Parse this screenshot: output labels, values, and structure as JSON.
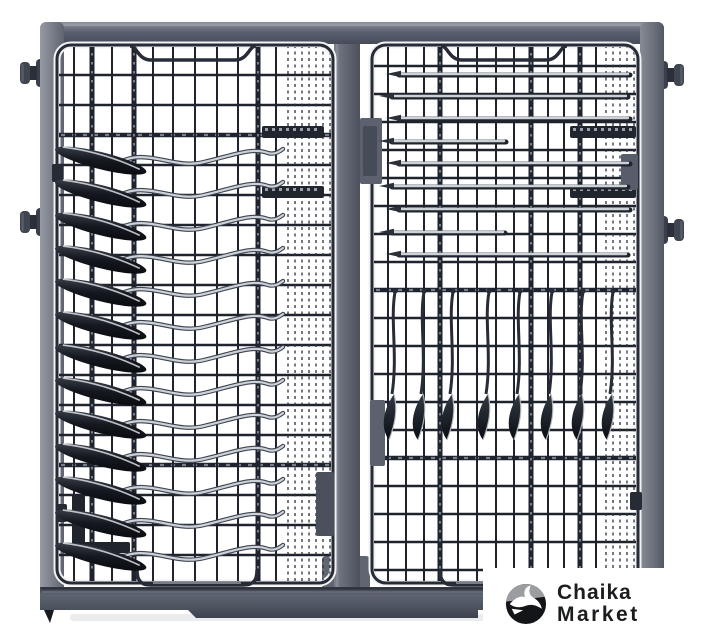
{
  "brand": {
    "line1": "Chaika",
    "line2": "Market"
  },
  "image": {
    "type": "product-photo",
    "subject": "dishwasher cutlery tray (third rack) loaded with knives and skewers, top view",
    "background": "#ffffff"
  },
  "colors": {
    "frame_gray": "#5d6370",
    "frame_light": "#8d929c",
    "wire_dark": "#1e232d",
    "wire_outline": "#262b35",
    "halo_white": "#f1f2f4",
    "metal_silver": "#cdd2d9",
    "utensil_dark": "#10131a",
    "logo_black": "#141518",
    "logo_gray": "#9b9da0",
    "text_dark": "#1b1d1f"
  },
  "scene": {
    "frame": {
      "top_bar": {
        "x": 40,
        "y": 22,
        "w": 624,
        "h": 22
      },
      "left_bar": {
        "x": 40,
        "y": 22,
        "w": 24,
        "h": 588
      },
      "right_bar": {
        "x": 640,
        "y": 22,
        "w": 24,
        "h": 600
      },
      "knobs": [
        {
          "side": "left",
          "x": 46,
          "y": 57
        },
        {
          "side": "left",
          "x": 46,
          "y": 206
        },
        {
          "side": "right",
          "x": 658,
          "y": 59
        },
        {
          "side": "right",
          "x": 658,
          "y": 214
        }
      ]
    },
    "divider": {
      "x": 334,
      "y": 44,
      "w": 26,
      "h": 546
    },
    "divider_foot": {
      "x": 322,
      "y": 556,
      "w": 48,
      "h": 34
    },
    "baskets": [
      {
        "id": "left",
        "x": 57,
        "y": 45,
        "w": 276,
        "h": 538,
        "r": 14,
        "verticals": [
          {
            "x": 74,
            "w": 2
          },
          {
            "x": 92,
            "w": 5
          },
          {
            "x": 112,
            "w": 2
          },
          {
            "x": 134,
            "w": 5
          },
          {
            "x": 153,
            "w": 2
          },
          {
            "x": 173,
            "w": 2
          },
          {
            "x": 195,
            "w": 2
          },
          {
            "x": 217,
            "w": 2
          },
          {
            "x": 238,
            "w": 2
          },
          {
            "x": 258,
            "w": 5
          },
          {
            "x": 276,
            "w": 2
          }
        ],
        "fine_verticals": {
          "from": 288,
          "to": 330,
          "step": 7
        },
        "horizontals": {
          "from": 75,
          "to": 575,
          "step": 30,
          "thick": [
            135,
            465
          ]
        }
      },
      {
        "id": "right",
        "x": 372,
        "y": 45,
        "w": 266,
        "h": 538,
        "r": 14,
        "verticals": [
          {
            "x": 388,
            "w": 2
          },
          {
            "x": 406,
            "w": 2
          },
          {
            "x": 424,
            "w": 2
          },
          {
            "x": 440,
            "w": 5
          },
          {
            "x": 458,
            "w": 2
          },
          {
            "x": 477,
            "w": 2
          },
          {
            "x": 496,
            "w": 2
          },
          {
            "x": 514,
            "w": 2
          },
          {
            "x": 531,
            "w": 5
          },
          {
            "x": 548,
            "w": 2
          },
          {
            "x": 564,
            "w": 2
          },
          {
            "x": 580,
            "w": 5
          },
          {
            "x": 596,
            "w": 2
          }
        ],
        "fine_verticals": {
          "from": 606,
          "to": 634,
          "step": 7
        },
        "horizontals": {
          "from": 66,
          "to": 570,
          "step": 28,
          "thick": [
            290,
            458
          ]
        }
      }
    ],
    "combs": [
      {
        "x": 262,
        "y": 126,
        "w": 62,
        "h": 12
      },
      {
        "x": 262,
        "y": 186,
        "w": 62,
        "h": 12
      },
      {
        "x": 570,
        "y": 126,
        "w": 66,
        "h": 12
      },
      {
        "x": 570,
        "y": 186,
        "w": 66,
        "h": 12
      }
    ],
    "blocks": [
      {
        "x": 360,
        "y": 118,
        "w": 22,
        "h": 66,
        "f": "#5b616e"
      },
      {
        "x": 363,
        "y": 126,
        "w": 14,
        "h": 50,
        "f": "#454b57"
      },
      {
        "x": 316,
        "y": 472,
        "w": 18,
        "h": 64,
        "f": "#4a505e"
      },
      {
        "x": 370,
        "y": 400,
        "w": 15,
        "h": 66,
        "f": "#5b616e"
      },
      {
        "x": 621,
        "y": 154,
        "w": 17,
        "h": 36,
        "f": "#575d6a"
      },
      {
        "x": 630,
        "y": 492,
        "w": 12,
        "h": 18,
        "f": "#262b34"
      },
      {
        "x": 52,
        "y": 164,
        "w": 11,
        "h": 18,
        "f": "#262b34"
      },
      {
        "x": 56,
        "y": 504,
        "w": 11,
        "h": 18,
        "f": "#262b34"
      },
      {
        "x": 72,
        "y": 495,
        "w": 13,
        "h": 52,
        "f": "#20242d"
      },
      {
        "x": 72,
        "y": 542,
        "w": 58,
        "h": 11,
        "f": "#20242d"
      }
    ],
    "top_dips": [
      {
        "x1": 130,
        "x2": 256
      },
      {
        "x1": 441,
        "x2": 567
      }
    ],
    "bottom_handles": [
      {
        "x1": 137,
        "x2": 257,
        "partial": false
      },
      {
        "x1": 440,
        "x2": 486,
        "partial": true
      }
    ],
    "left_utensils": {
      "ys": [
        140,
        173,
        206,
        239,
        272,
        305,
        338,
        371,
        404,
        437,
        470,
        503,
        536
      ]
    },
    "skewers": [
      {
        "y": 74,
        "x1": 386,
        "x2": 630
      },
      {
        "y": 96,
        "x1": 379,
        "x2": 628
      },
      {
        "y": 118,
        "x1": 386,
        "x2": 630
      },
      {
        "y": 141,
        "x1": 379,
        "x2": 506
      },
      {
        "y": 163,
        "x1": 386,
        "x2": 630
      },
      {
        "y": 186,
        "x1": 379,
        "x2": 628
      },
      {
        "y": 209,
        "x1": 386,
        "x2": 630
      },
      {
        "y": 232,
        "x1": 379,
        "x2": 505
      },
      {
        "y": 254,
        "x1": 386,
        "x2": 628
      }
    ],
    "hanging_knives": {
      "xs": [
        392,
        421,
        450,
        486,
        517,
        549,
        580,
        610
      ],
      "top": 292,
      "blade_top": 394,
      "blade_bottom": 440
    },
    "rail": {
      "x": 40,
      "y": 587,
      "x2": 664,
      "bottom": 610,
      "lip_x1": 188,
      "lip_x2": 478,
      "lip_bottom": 618
    }
  }
}
